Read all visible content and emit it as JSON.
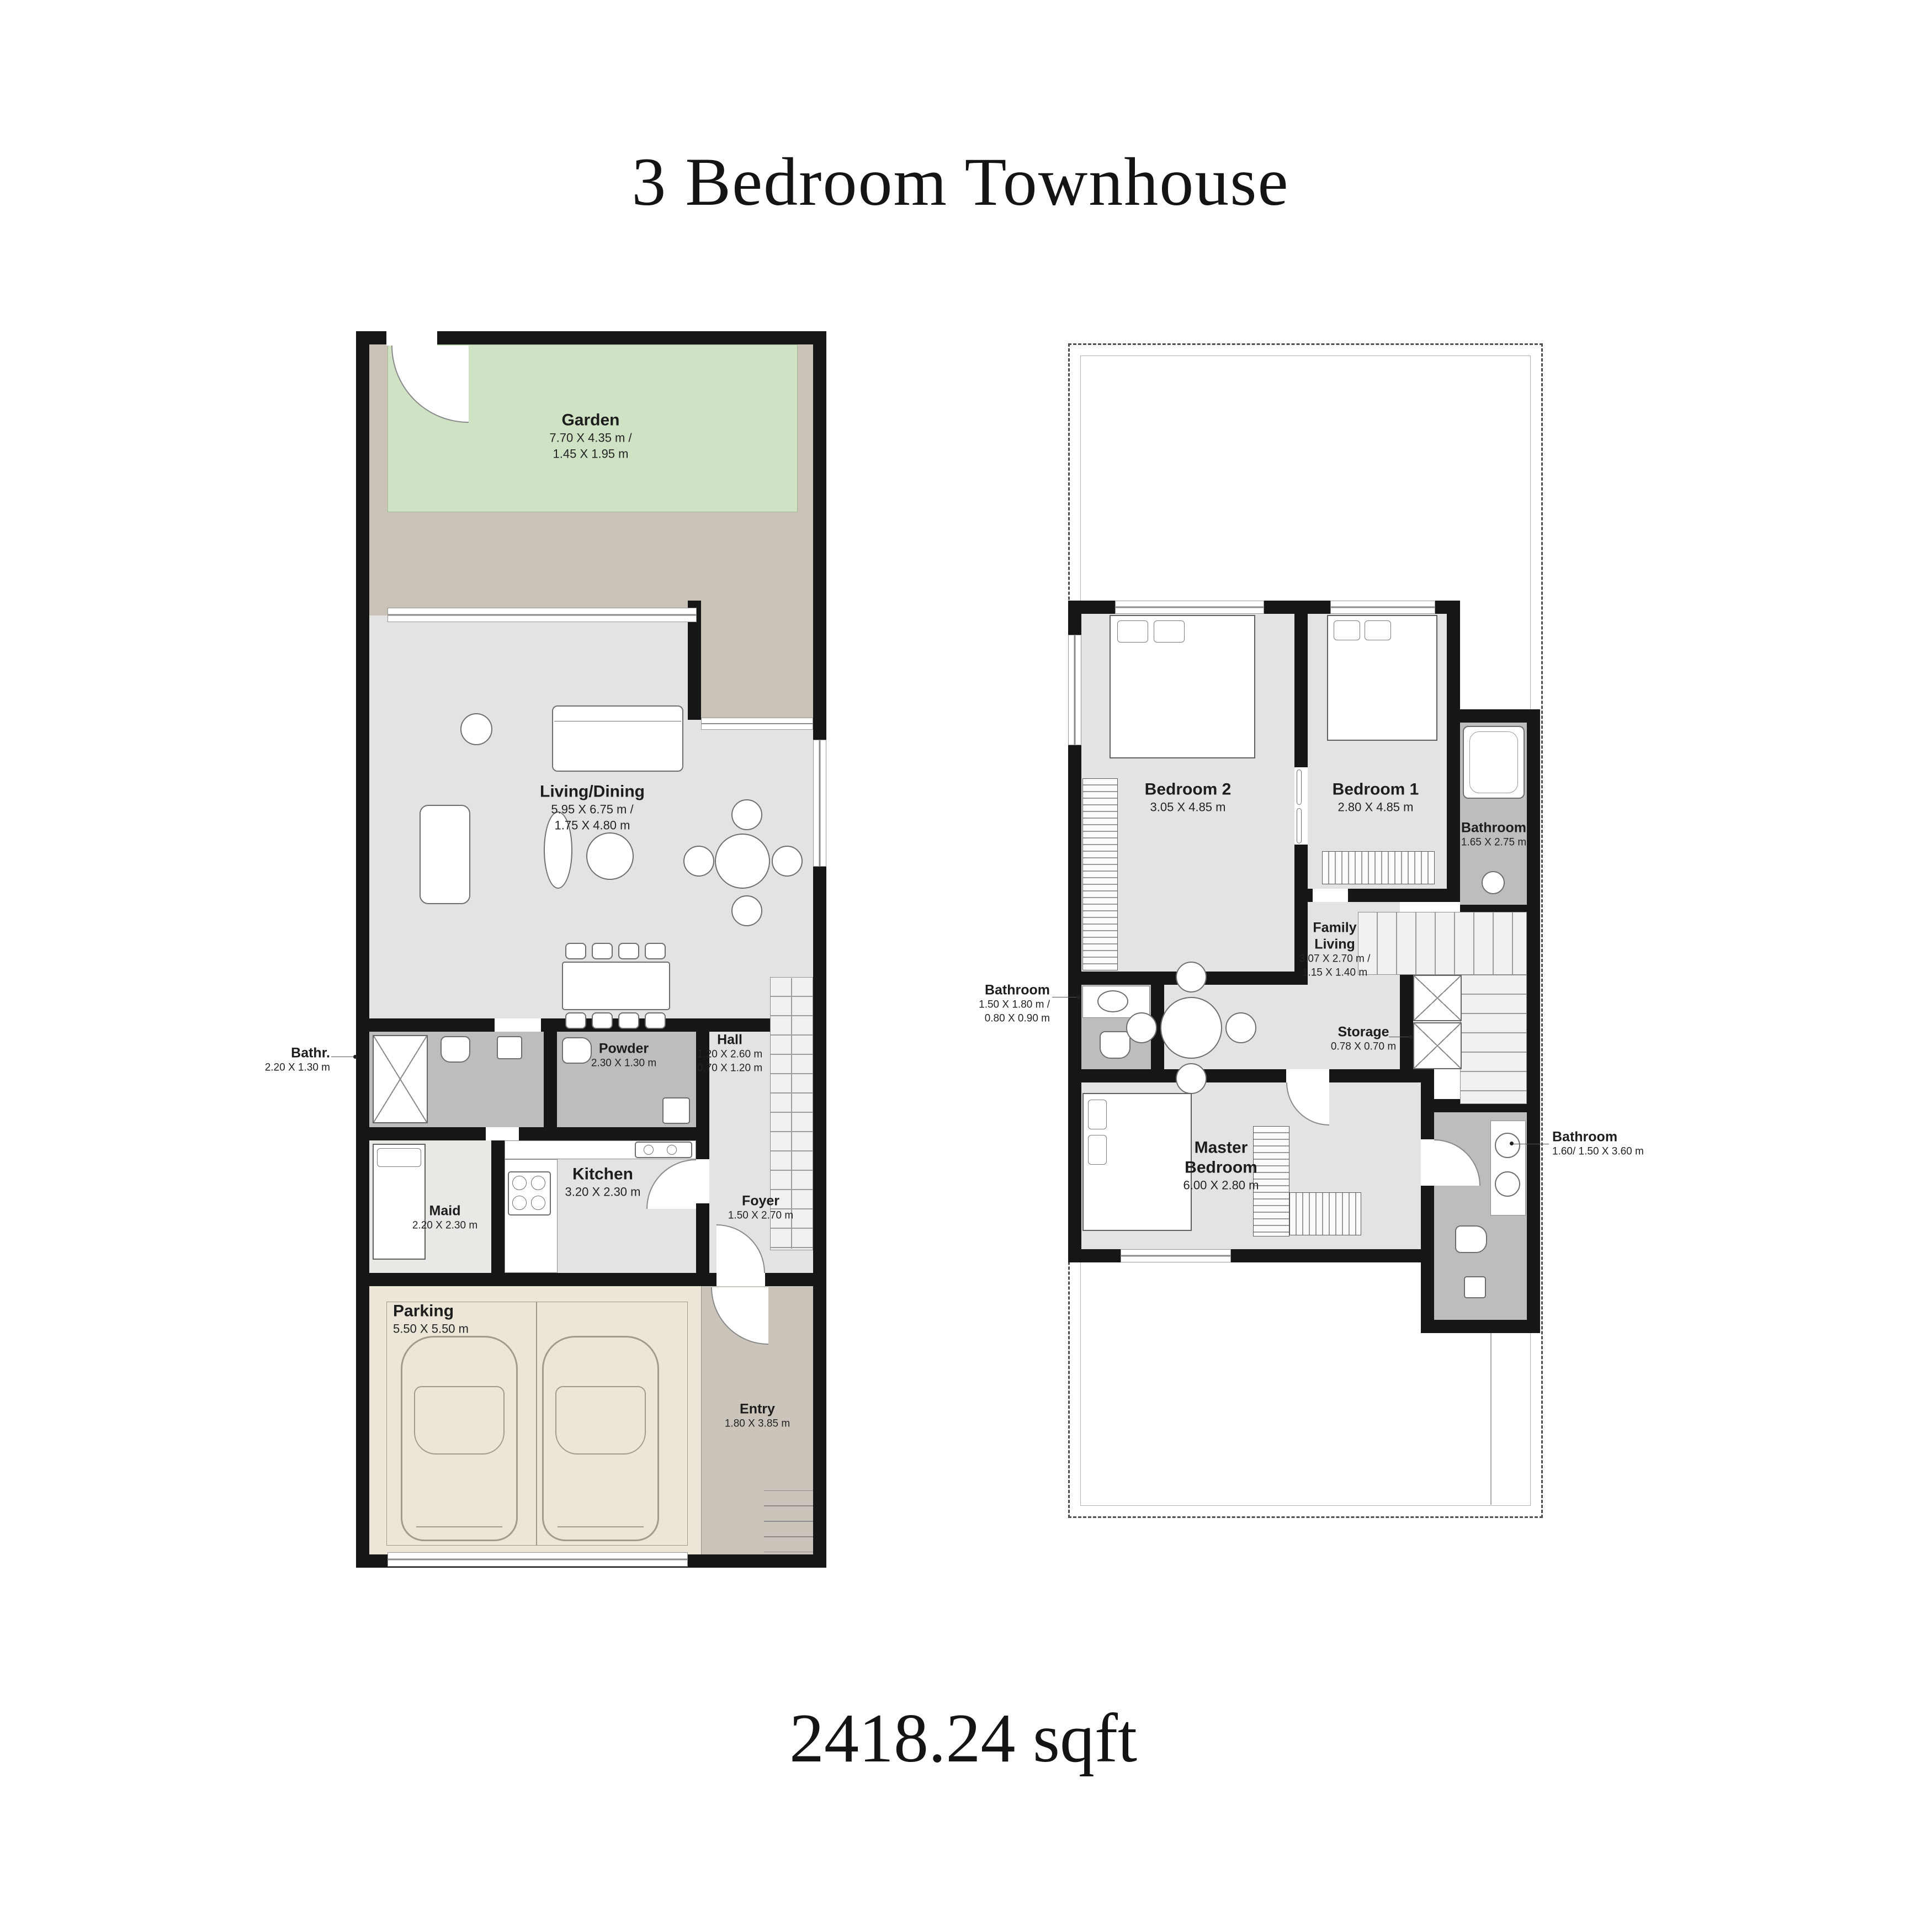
{
  "title": "3 Bedroom Townhouse",
  "area": "2418.24 sqft",
  "colors": {
    "wall": "#161616",
    "room_floor": "#e3e4e2",
    "bath_floor": "#bdbebc",
    "garden": "#cfe2c3",
    "terrace": "#c9c2b7",
    "parking": "#ece6d9",
    "entry": "#cbc4ba"
  },
  "ground_floor": {
    "garden": {
      "name": "Garden",
      "dims1": "7.70 X 4.35 m /",
      "dims2": "1.45 X 1.95 m"
    },
    "living": {
      "name": "Living/Dining",
      "dims1": "5.95 X 6.75 m /",
      "dims2": "1.75 X 4.80 m"
    },
    "bathr": {
      "name": "Bathr.",
      "dims1": "2.20 X 1.30 m"
    },
    "powder": {
      "name": "Powder",
      "dims1": "2.30 X 1.30 m"
    },
    "hall": {
      "name": "Hall",
      "dims1": "1.20 X 2.60 m",
      "dims2": "0.70 X 1.20 m"
    },
    "kitchen": {
      "name": "Kitchen",
      "dims1": "3.20 X 2.30 m"
    },
    "maid": {
      "name": "Maid",
      "dims1": "2.20 X 2.30 m"
    },
    "foyer": {
      "name": "Foyer",
      "dims1": "1.50 X 2.70 m"
    },
    "parking": {
      "name": "Parking",
      "dims1": "5.50 X 5.50 m"
    },
    "entry": {
      "name": "Entry",
      "dims1": "1.80 X 3.85 m"
    }
  },
  "first_floor": {
    "bedroom2": {
      "name": "Bedroom 2",
      "dims1": "3.05 X 4.85 m"
    },
    "bedroom1": {
      "name": "Bedroom 1",
      "dims1": "2.80 X 4.85 m"
    },
    "bathroom_top": {
      "name": "Bathroom",
      "dims1": "1.65 X 2.75 m"
    },
    "bathroom_left": {
      "name": "Bathroom",
      "dims1": "1.50 X 1.80 m /",
      "dims2": "0.80 X 0.90 m"
    },
    "family_living": {
      "name1": "Family",
      "name2": "Living",
      "dims1": "3.07 X 2.70 m /",
      "dims2": "1.15 X 1.40 m"
    },
    "storage": {
      "name": "Storage",
      "dims1": "0.78 X 0.70 m"
    },
    "master": {
      "name1": "Master",
      "name2": "Bedroom",
      "dims1": "6.00 X 2.80 m"
    },
    "bathroom_bottom": {
      "name": "Bathroom",
      "dims1": "1.60/ 1.50 X 3.60 m"
    }
  }
}
